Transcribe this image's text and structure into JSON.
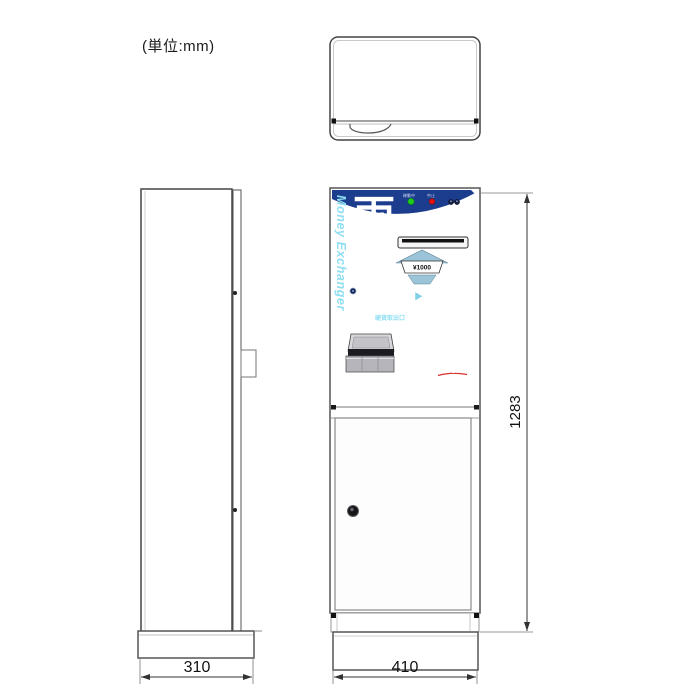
{
  "unit_label": "(単位:mm)",
  "front_panel": {
    "title": "両替",
    "subtitle": "Money Exchanger",
    "lamp_green_label": "稼動中",
    "lamp_red_label": "中止",
    "bill_label": "¥1000",
    "exchange_from": "¥1000",
    "exchange_arrow": "▶",
    "exchange_to": "¥500 × 2枚",
    "coin_outlet_title": "硬貨取出口",
    "coin_outlet_note": "硬貨の取り忘れにご注意ください",
    "model_label": "Model ACS-EC500",
    "brand": "OCF"
  },
  "dimensions": {
    "side_width_mm": "310",
    "front_width_mm": "410",
    "height_mm": "1283"
  },
  "colors": {
    "panel_blue": "#1c3c8e",
    "accent_cyan": "#8edff2",
    "lamp_green": "#1ecb1e",
    "lamp_red": "#e51212",
    "steel_blue": "#9cc4d8",
    "line_dark": "#444444"
  }
}
